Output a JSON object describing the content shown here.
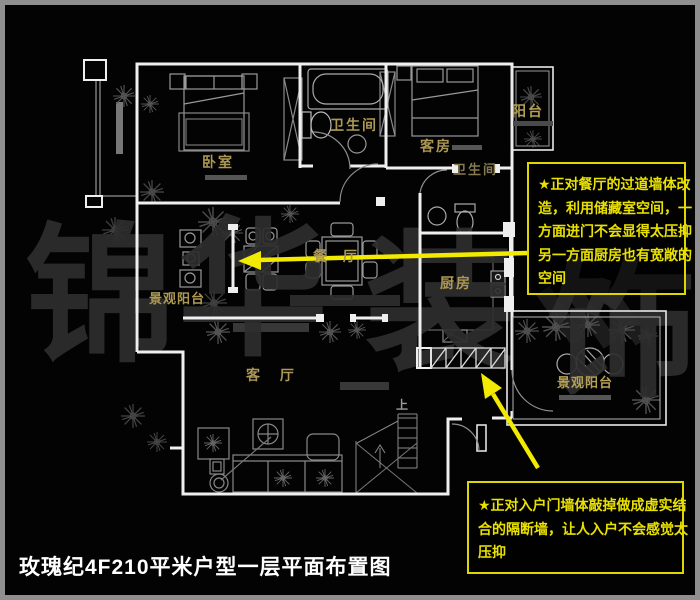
{
  "title": "玫瑰纪4F210平米户型一层平面布置图",
  "watermark": {
    "char1": "锦",
    "char2": "华",
    "dash": "—",
    "char3": "装",
    "char4": "饰"
  },
  "rooms": {
    "bedroom": "卧室",
    "bathroom1": "卫生间",
    "guest_room": "客房",
    "balcony_top": "阳台",
    "bathroom2": "卫生间",
    "dining": "餐 厅",
    "kitchen": "厨房",
    "balcony_left": "景观阳台",
    "living": "客 厅",
    "balcony_right": "景观阳台",
    "stairs_up": "上"
  },
  "annotations": {
    "note1": {
      "lines": [
        "★正对餐厅的过道墙体改",
        "造，利用储藏室空间，一",
        "方面进门不会显得太压抑",
        "另一方面厨房也有宽敞的",
        "空间"
      ]
    },
    "note2": {
      "lines": [
        "★正对入户门墙体敲掉做成虚实结",
        "合的隔断墙，让人入户不会感觉太",
        "压抑"
      ]
    }
  },
  "colors": {
    "annotation_yellow": "#e9e100",
    "arrow_yellow": "#f2ea00",
    "label_gold": "#ad9955",
    "wall_white": "#efefef",
    "watermark_gray": "#2e2e2e",
    "frame_gray": "#8f8f8f"
  }
}
